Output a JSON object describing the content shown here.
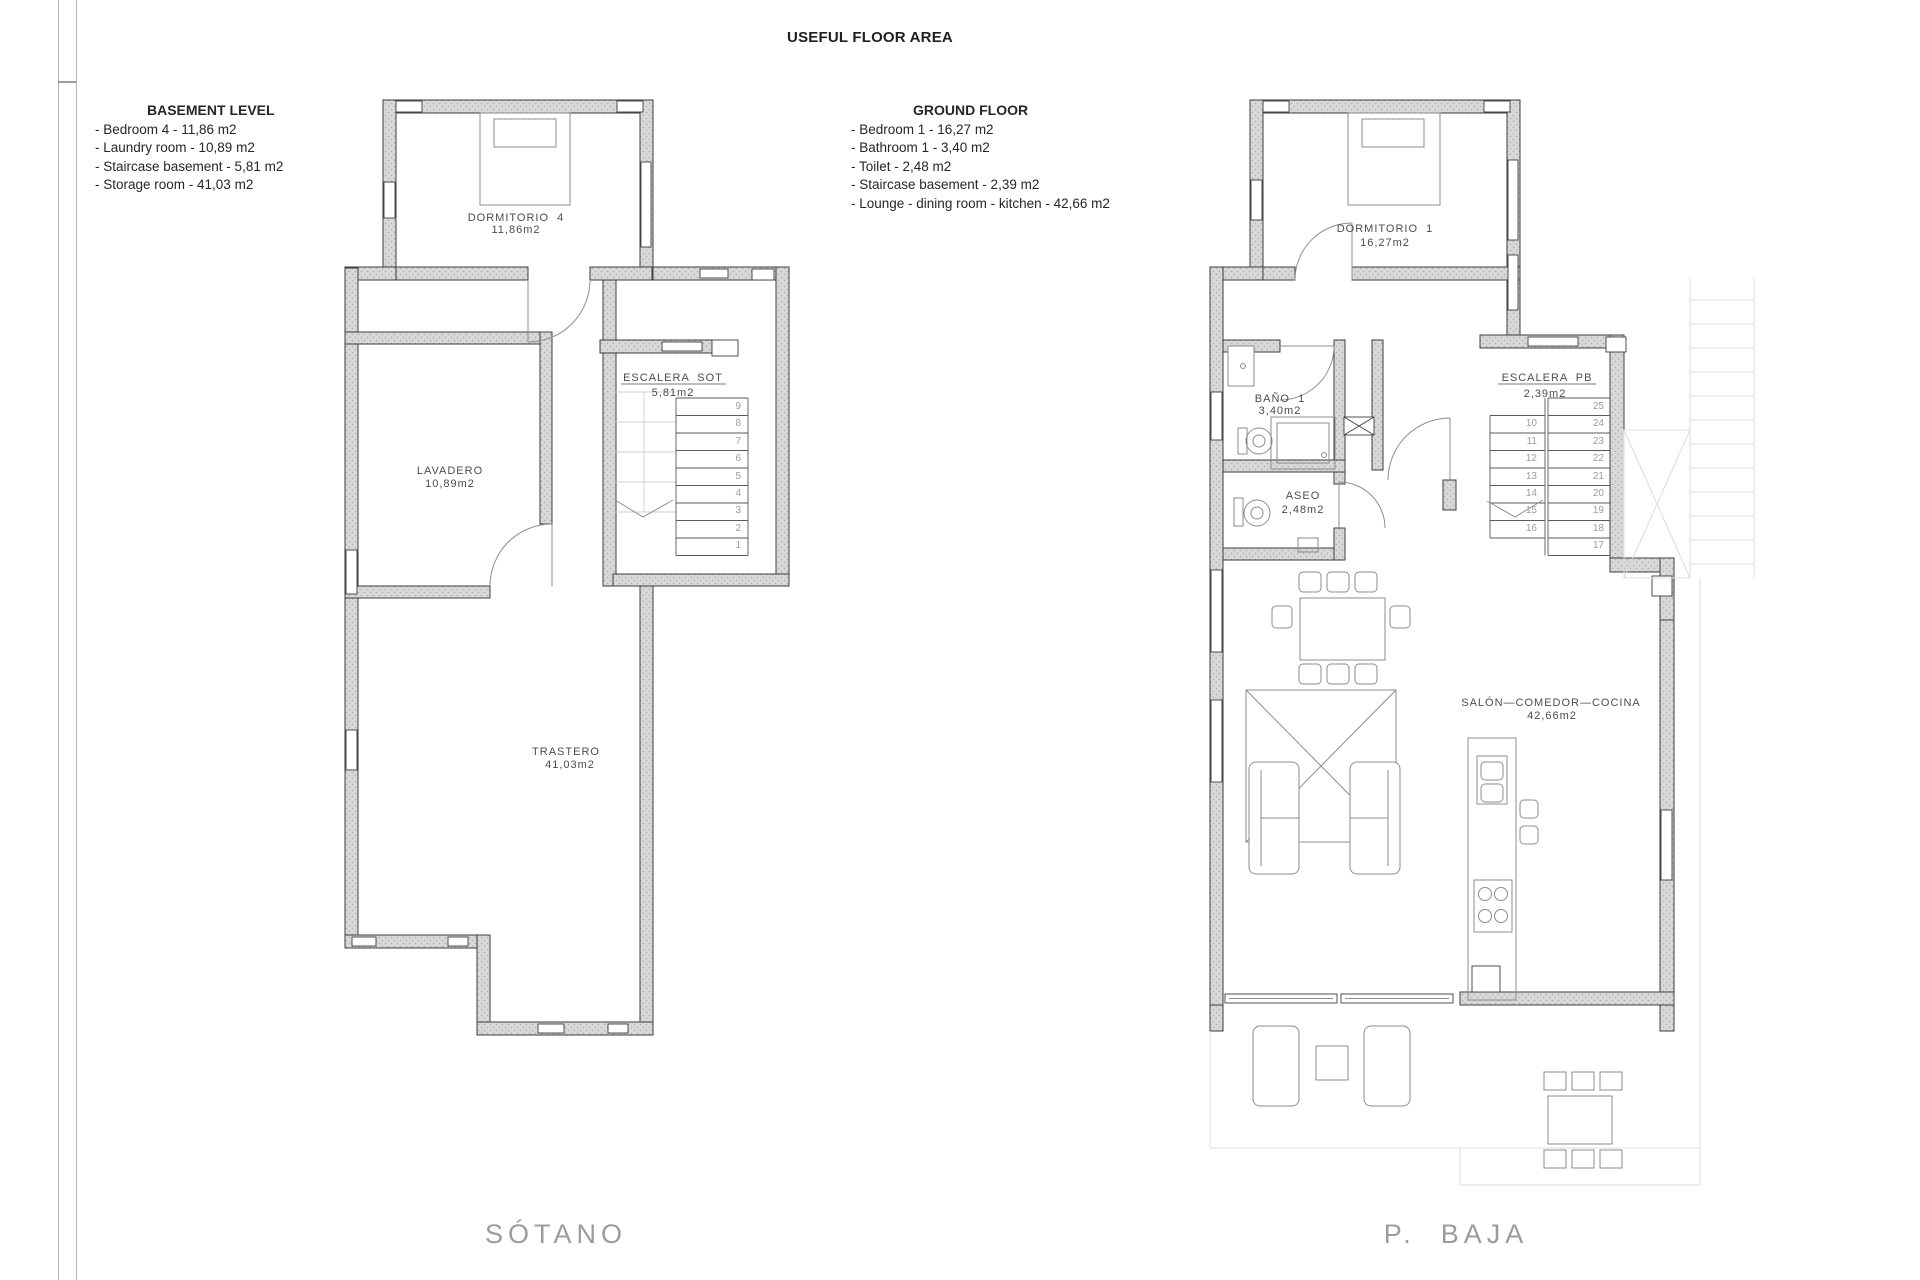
{
  "title": "USEFUL FLOOR AREA",
  "legends": {
    "basement": {
      "heading": "BASEMENT LEVEL",
      "items": [
        "- Bedroom 4 - 11,86 m2",
        "- Laundry room - 10,89 m2",
        "- Staircase basement - 5,81 m2",
        "- Storage room - 41,03 m2"
      ]
    },
    "ground": {
      "heading": "GROUND FLOOR",
      "items": [
        "- Bedroom 1 - 16,27 m2",
        "- Bathroom 1 - 3,40 m2",
        "- Toilet - 2,48 m2",
        "- Staircase basement - 2,39 m2",
        "- Lounge - dining room - kitchen - 42,66 m2"
      ]
    }
  },
  "basement_plan": {
    "label": "SÓTANO",
    "rooms": {
      "dormitorio4": {
        "name": "DORMITORIO  4",
        "area": "11,86m2"
      },
      "lavadero": {
        "name": "LAVADERO",
        "area": "10,89m2"
      },
      "escalera": {
        "name": "ESCALERA  SOT",
        "area": "5,81m2"
      },
      "trastero": {
        "name": "TRASTERO",
        "area": "41,03m2"
      }
    },
    "stairs": [
      "9",
      "8",
      "7",
      "6",
      "5",
      "4",
      "3",
      "2",
      "1"
    ]
  },
  "ground_plan": {
    "label": "P.  BAJA",
    "rooms": {
      "dormitorio1": {
        "name": "DORMITORIO  1",
        "area": "16,27m2"
      },
      "bano": {
        "name": "BAÑO  1",
        "area": "3,40m2"
      },
      "aseo": {
        "name": "ASEO",
        "area": "2,48m2"
      },
      "escalera": {
        "name": "ESCALERA  PB",
        "area": "2,39m2"
      },
      "salon": {
        "name": "SALÓN—COMEDOR—COCINA",
        "area": "42,66m2"
      }
    },
    "stairs_left": [
      "10",
      "11",
      "12",
      "13",
      "14",
      "15",
      "16"
    ],
    "stairs_right": [
      "25",
      "24",
      "23",
      "22",
      "21",
      "20",
      "19",
      "18",
      "17"
    ]
  },
  "colors": {
    "wall_fill": "#d9d9d9",
    "wall_dot": "#b3b3b3",
    "line": "#3d3d3d",
    "label": "#4c4c4c",
    "plan_label": "#9c9c9c"
  }
}
